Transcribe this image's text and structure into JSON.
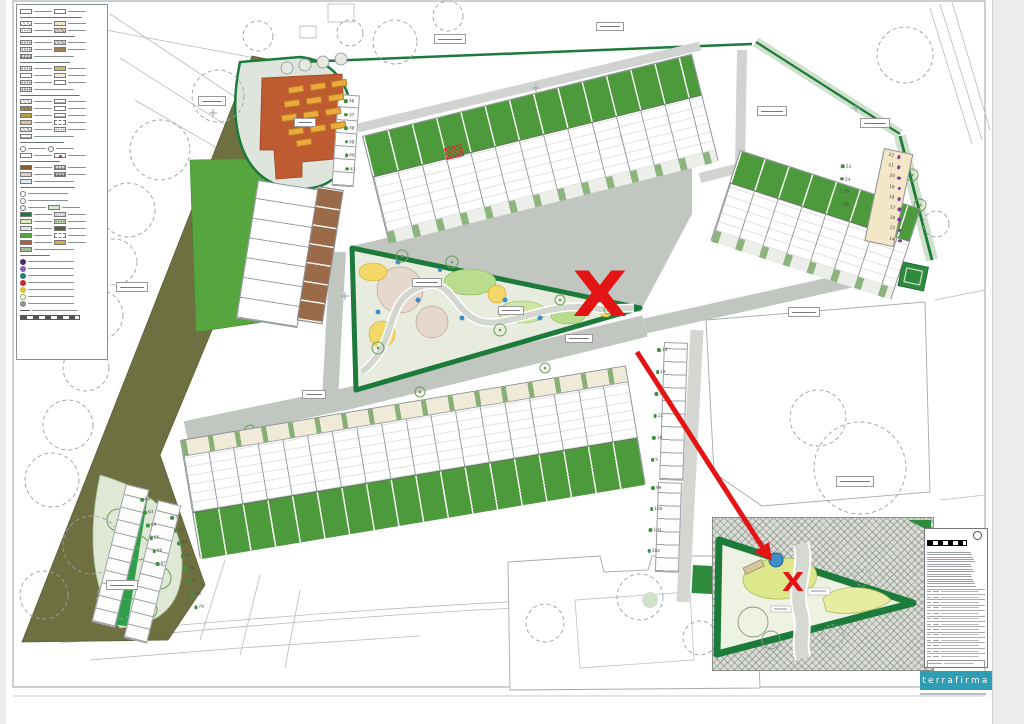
{
  "plan": {
    "marker": "X",
    "care_home_bars": [
      [
        288,
        86,
        -8
      ],
      [
        310,
        83,
        -8
      ],
      [
        331,
        80,
        -8
      ],
      [
        284,
        100,
        -8
      ],
      [
        306,
        97,
        -8
      ],
      [
        328,
        94,
        -8
      ],
      [
        281,
        114,
        -8
      ],
      [
        303,
        111,
        -8
      ],
      [
        325,
        108,
        -8
      ],
      [
        288,
        128,
        -8
      ],
      [
        310,
        125,
        -8
      ],
      [
        330,
        122,
        -8
      ],
      [
        296,
        139,
        -8
      ]
    ],
    "number_columns": [
      {
        "x": 889,
        "y": 153,
        "dx": 2.3,
        "dy": 10.2,
        "rot": 12,
        "dot": "#7b3f8f",
        "dotSide": "r",
        "values": [
          "22",
          "21",
          "20",
          "19",
          "18",
          "17",
          "16",
          "15",
          "14"
        ]
      },
      {
        "x": 841,
        "y": 164,
        "dx": 1,
        "dy": 12.5,
        "rot": 8,
        "dot": "#3f8f3f",
        "dotSide": "l",
        "values": [
          "23",
          "24",
          "25",
          "26"
        ]
      },
      {
        "x": 657,
        "y": 348,
        "dx": -0.5,
        "dy": 22,
        "rot": 2,
        "dot": "#3f8f3f",
        "dotSide": "l",
        "values": [
          "14",
          "13",
          "12",
          "11",
          "10",
          "9"
        ]
      },
      {
        "x": 651,
        "y": 486,
        "dx": -0.5,
        "dy": 21,
        "rot": 2,
        "dot": "#3f8f3f",
        "dotSide": "l",
        "values": [
          "99",
          "100",
          "101",
          "102"
        ]
      },
      {
        "x": 140,
        "y": 498,
        "dx": 2.2,
        "dy": 13,
        "rot": -4,
        "dot": "#3f8f3f",
        "dotSide": "l",
        "values": [
          "62",
          "63",
          "64",
          "65",
          "66",
          "67"
        ]
      },
      {
        "x": 170,
        "y": 516,
        "dx": 2.5,
        "dy": 13,
        "rot": -4,
        "dot": "#3f8f3f",
        "dotSide": "l",
        "values": [
          "72",
          "73",
          "74",
          "75",
          "76",
          "77",
          "78",
          "79"
        ]
      },
      {
        "x": 344,
        "y": 99,
        "dx": 1.2,
        "dy": 13.5,
        "rot": 4,
        "dot": "#3f8f3f",
        "dotSide": "l",
        "values": [
          "36",
          "37",
          "38",
          "39",
          "40",
          "41"
        ]
      }
    ],
    "label_boxes": [
      [
        198,
        96,
        26,
        8
      ],
      [
        294,
        118,
        20,
        7
      ],
      [
        116,
        282,
        30,
        8
      ],
      [
        56,
        350,
        26,
        8
      ],
      [
        434,
        34,
        30,
        8
      ],
      [
        596,
        22,
        26,
        7
      ],
      [
        757,
        106,
        28,
        8
      ],
      [
        788,
        307,
        30,
        8
      ],
      [
        836,
        476,
        36,
        9
      ],
      [
        565,
        334,
        26,
        7
      ],
      [
        106,
        580,
        30,
        8
      ],
      [
        860,
        118,
        28,
        8
      ],
      [
        412,
        278,
        28,
        7
      ],
      [
        498,
        306,
        24,
        7
      ],
      [
        302,
        390,
        22,
        7
      ]
    ],
    "trees_dashed": [
      [
        395,
        42,
        22
      ],
      [
        448,
        16,
        15
      ],
      [
        218,
        96,
        26
      ],
      [
        160,
        150,
        30
      ],
      [
        128,
        210,
        27
      ],
      [
        114,
        262,
        23
      ],
      [
        98,
        315,
        25
      ],
      [
        86,
        368,
        23
      ],
      [
        68,
        425,
        25
      ],
      [
        52,
        480,
        27
      ],
      [
        92,
        545,
        29
      ],
      [
        44,
        595,
        24
      ],
      [
        118,
        598,
        21
      ],
      [
        905,
        55,
        28
      ],
      [
        936,
        224,
        13
      ],
      [
        860,
        468,
        46
      ],
      [
        818,
        418,
        28
      ],
      [
        640,
        597,
        23
      ],
      [
        700,
        638,
        17
      ],
      [
        545,
        623,
        19
      ],
      [
        350,
        33,
        13
      ],
      [
        258,
        36,
        15
      ]
    ],
    "trees_green": [
      [
        118,
        520,
        11
      ],
      [
        138,
        548,
        12
      ],
      [
        160,
        578,
        11
      ],
      [
        128,
        590,
        10
      ],
      [
        148,
        610,
        9
      ],
      [
        378,
        348,
        6
      ],
      [
        402,
        256,
        6
      ],
      [
        452,
        262,
        6
      ],
      [
        500,
        330,
        6
      ],
      [
        560,
        300,
        5
      ],
      [
        608,
        310,
        4
      ],
      [
        250,
        430,
        5
      ],
      [
        420,
        392,
        5
      ],
      [
        545,
        368,
        5
      ],
      [
        912,
        175,
        6
      ],
      [
        920,
        205,
        6
      ]
    ],
    "trees_gray": [
      [
        287,
        68,
        6
      ],
      [
        305,
        65,
        6
      ],
      [
        323,
        62,
        6
      ],
      [
        341,
        59,
        6
      ]
    ]
  },
  "inset": {
    "marker": "X"
  },
  "titleblock": {
    "logo_text": "terrafirma",
    "logo_color": "#2f9db3",
    "paragraph_lines": [
      5,
      4,
      6
    ],
    "revision_rows": 13
  },
  "legend": {
    "rows": [
      {
        "t": "s",
        "cells": [
          {
            "c": "#ffffff",
            "gw": 18
          },
          {
            "c": "#ffffff",
            "gw": 18
          }
        ]
      },
      {
        "t": "h",
        "w": 62
      },
      {
        "t": "s",
        "cells": [
          {
            "c": "#ffffff",
            "p": "diag",
            "gw": 18
          },
          {
            "c": "#f3e6c4",
            "gw": 18
          }
        ]
      },
      {
        "t": "s",
        "cells": [
          {
            "c": "#ffffff",
            "p": "dot",
            "gw": 18
          },
          {
            "c": "#eccfc7",
            "p": "diag",
            "gw": 18
          }
        ]
      },
      {
        "t": "h",
        "w": 55
      },
      {
        "t": "s",
        "cells": [
          {
            "c": "#e9e9e9",
            "p": "dot",
            "gw": 18
          },
          {
            "c": "#dcdcdc",
            "p": "diag",
            "gw": 18
          }
        ]
      },
      {
        "t": "s",
        "cells": [
          {
            "c": "#e9e9e9",
            "p": "dot",
            "gw": 18
          },
          {
            "c": "#9c7f55",
            "gw": 18
          }
        ]
      },
      {
        "t": "s",
        "cells": [
          {
            "c": "#d9d9d9",
            "p": "grid",
            "gw": 40
          }
        ]
      },
      {
        "t": "h",
        "w": 50
      },
      {
        "t": "s",
        "cells": [
          {
            "c": "#efefef",
            "p": "dot",
            "gw": 18
          },
          {
            "c": "#cdbb74",
            "gw": 18
          }
        ]
      },
      {
        "t": "s",
        "cells": [
          {
            "c": "#ffffff",
            "gw": 18
          },
          {
            "c": "#f1ecdb",
            "gw": 18
          }
        ]
      },
      {
        "t": "s",
        "cells": [
          {
            "c": "#e9e9e9",
            "p": "dot",
            "gw": 18
          },
          {
            "c": "#ffffff",
            "gw": 18
          }
        ]
      },
      {
        "t": "s",
        "cells": [
          {
            "c": "#e0e0e0",
            "p": "dot",
            "gw": 40
          }
        ]
      },
      {
        "t": "h",
        "w": 60
      },
      {
        "t": "s",
        "cells": [
          {
            "c": "#ffffff",
            "p": "diag",
            "gw": 18
          },
          {
            "c": "#ffffff",
            "p": "line",
            "gw": 18
          }
        ]
      },
      {
        "t": "s",
        "cells": [
          {
            "c": "#b98c4a",
            "p": "diag",
            "gw": 18
          },
          {
            "c": "#ffffff",
            "gw": 18
          }
        ]
      },
      {
        "t": "s",
        "cells": [
          {
            "c": "#b4a24a",
            "gw": 18
          },
          {
            "c": "#ffffff",
            "p": "line",
            "gw": 18
          }
        ]
      },
      {
        "t": "s",
        "cells": [
          {
            "c": "#d8c49a",
            "gw": 18
          },
          {
            "c": "#ffffff",
            "p": "dash",
            "gw": 18
          }
        ]
      },
      {
        "t": "s",
        "cells": [
          {
            "c": "#efefef",
            "p": "diag",
            "gw": 18
          },
          {
            "c": "#ffffff",
            "p": "dot",
            "gw": 18
          }
        ]
      },
      {
        "t": "s",
        "cells": [
          {
            "c": "#ffffff",
            "p": "line",
            "gw": 40
          }
        ]
      },
      {
        "t": "h",
        "w": 44
      },
      {
        "t": "s",
        "cells": [
          {
            "c": "#ffffff",
            "ci": 1,
            "gw": 18
          },
          {
            "c": "#ffffff",
            "ci": 1,
            "gw": 18
          }
        ]
      },
      {
        "t": "s",
        "cells": [
          {
            "c": "#ffffff",
            "gw": 18
          },
          {
            "c": "#ffffff",
            "rd": 1,
            "gw": 18
          }
        ]
      },
      {
        "t": "h",
        "w": 40
      },
      {
        "t": "s",
        "cells": [
          {
            "c": "#8a5a33",
            "gw": 18
          },
          {
            "c": "#dddddd",
            "p": "grid",
            "gw": 18
          }
        ]
      },
      {
        "t": "s",
        "cells": [
          {
            "c": "#e3cfc7",
            "gw": 18
          },
          {
            "c": "#bbbbbb",
            "p": "grid",
            "gw": 18
          }
        ]
      },
      {
        "t": "s",
        "cells": [
          {
            "c": "#dce9f5",
            "gw": 40
          }
        ]
      },
      {
        "t": "h",
        "w": 55
      },
      {
        "t": "s",
        "cells": [
          {
            "c": "#ffffff",
            "ci": 1,
            "gw": 40
          }
        ]
      },
      {
        "t": "s",
        "cells": [
          {
            "c": "#ffffff",
            "ci": 1,
            "gw": 40
          }
        ]
      },
      {
        "t": "s",
        "cells": [
          {
            "c": "#eeeeee",
            "ci": 1,
            "gw": 18
          },
          {
            "c": "#d5e6d0",
            "gw": 18
          }
        ]
      },
      {
        "t": "s",
        "cells": [
          {
            "c": "#1c7a3a",
            "gw": 18
          },
          {
            "c": "#d9d5e8",
            "gw": 18
          }
        ]
      },
      {
        "t": "s",
        "cells": [
          {
            "c": "#dcecb9",
            "gw": 18
          },
          {
            "c": "#cfe0c0",
            "p": "dot",
            "gw": 18
          }
        ]
      },
      {
        "t": "s",
        "cells": [
          {
            "c": "#e2e9dc",
            "gw": 18
          },
          {
            "c": "#5f6535",
            "gw": 18
          }
        ]
      },
      {
        "t": "s",
        "cells": [
          {
            "c": "#57a53e",
            "gw": 18
          },
          {
            "c": "#ffffff",
            "p": "dash",
            "gw": 18
          }
        ]
      },
      {
        "t": "s",
        "cells": [
          {
            "c": "#bf5b30",
            "gw": 18
          },
          {
            "c": "#d9a940",
            "gw": 18
          }
        ]
      },
      {
        "t": "s",
        "cells": [
          {
            "c": "#9fbf9a",
            "gw": 40
          }
        ]
      },
      {
        "t": "h",
        "w": 30
      },
      {
        "t": "d",
        "c": "#4a2d68"
      },
      {
        "t": "d",
        "c": "#8a5fb0"
      },
      {
        "t": "d",
        "c": "#2e7d6b"
      },
      {
        "t": "d",
        "c": "#c62828"
      },
      {
        "t": "d",
        "c": "#e2b93b"
      },
      {
        "t": "d",
        "c": "#76b041",
        "ring": 1
      },
      {
        "t": "d",
        "c": "#8f8f8f"
      },
      {
        "t": "d",
        "c": "#555555",
        "line": 1
      },
      {
        "t": "r"
      }
    ]
  }
}
